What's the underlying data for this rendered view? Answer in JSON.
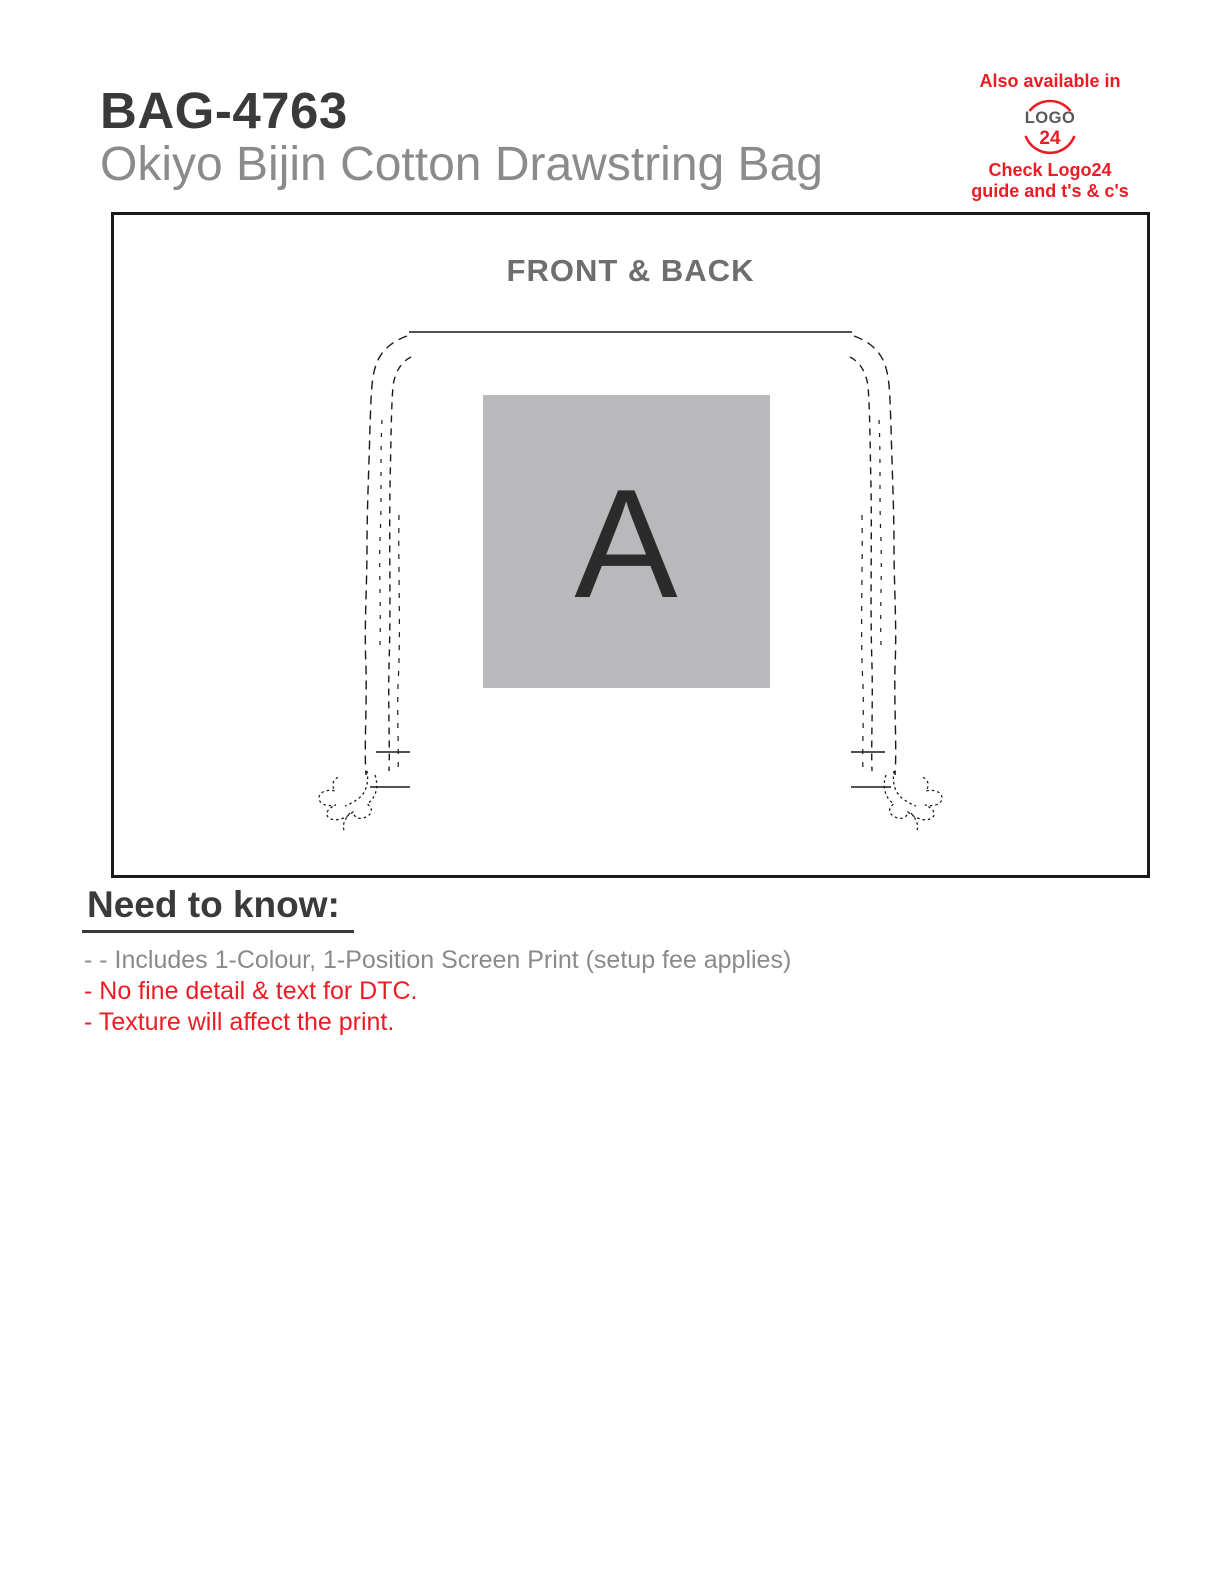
{
  "header": {
    "product_code": "BAG-4763",
    "product_name": "Okiyo Bijin Cotton Drawstring Bag"
  },
  "logo24": {
    "availability_note": "Also available in",
    "logo_text": "LOGO",
    "logo_number": "24",
    "caption_line1": "Check Logo24",
    "caption_line2": "guide and t's & c's"
  },
  "artwork": {
    "panel_title": "FRONT & BACK",
    "print_area_label": "A"
  },
  "need_to_know": {
    "heading": "Need to know:",
    "notes": [
      {
        "text": "- - Includes 1-Colour, 1-Position Screen Print (setup fee applies)",
        "color": "gray"
      },
      {
        "text": "- No fine detail & text for DTC.",
        "color": "red"
      },
      {
        "text": "- Texture will affect the print.",
        "color": "red"
      }
    ]
  },
  "colors": {
    "accent_red": "#ed1c24",
    "title_dark": "#3a3a3a",
    "body_gray": "#8a8a8a",
    "panel_title_gray": "#6e6e70",
    "logo_word_gray": "#58595b",
    "print_area_gray": "#b9b9bb",
    "line_black": "#1a1a1a"
  }
}
